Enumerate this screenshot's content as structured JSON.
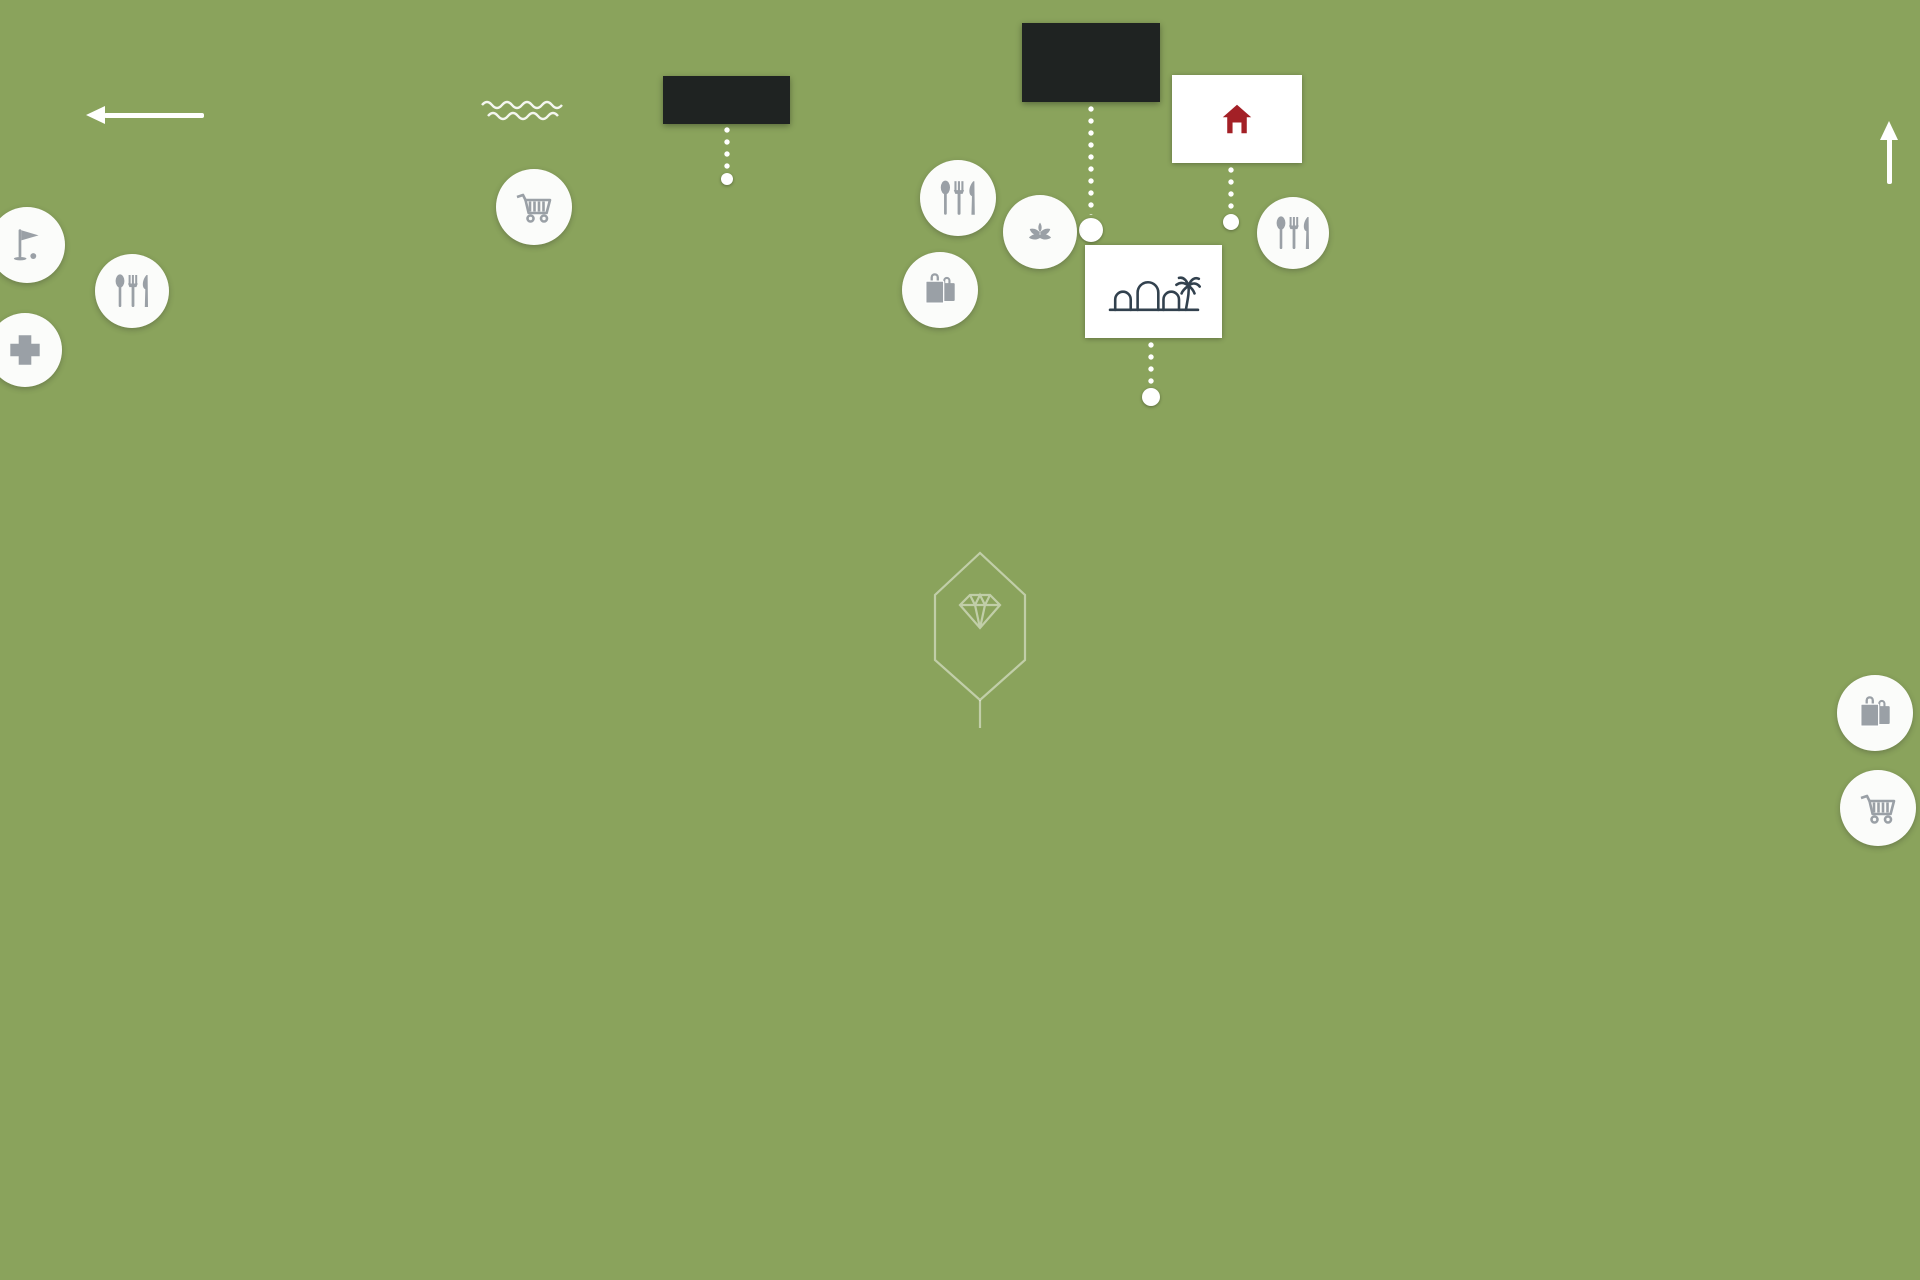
{
  "overlay": {
    "title_line1": "CIUDAD QUESADA",
    "title_line2": "AERIAL VIEW",
    "direction_west": "GUARDAMAR",
    "direction_east": "TORREVIEJA",
    "sea_label": "MEDITERRANEAN SEA",
    "lagoon_label": "SALT LAGOONS"
  },
  "badges": {
    "apartments": {
      "line1": "APARTMENTS",
      "line2": "LA LAGUNA"
    },
    "hotel": {
      "line1": "HOTEL",
      "line2": "LA LAGUNA",
      "line3": "SPA & GOLF",
      "stars": "★ ★ ★ ★"
    },
    "euromarina": {
      "part1": "euro",
      "part2": "marina"
    },
    "marella": {
      "name": "MARELLA",
      "subtitle": "garden"
    }
  },
  "amenities": {
    "spa_text": "SPA",
    "icons": [
      "golf-icon",
      "restaurant-icon",
      "pharmacy-cross-icon",
      "shopping-cart-icon",
      "restaurant-icon",
      "spa-icon",
      "shopping-bags-icon",
      "restaurant-icon",
      "shopping-bags-icon",
      "shopping-cart-icon"
    ]
  },
  "watermark": {
    "line1": "BLANC HOMES",
    "line2": "INMOBILIARIA"
  },
  "colors": {
    "brand_red": "#a51e22",
    "badge_dark": "#1a1d21",
    "logo_navy": "#32414e",
    "icon_gray": "#9aa0a6",
    "pool_blue": "#4fc0e4"
  }
}
